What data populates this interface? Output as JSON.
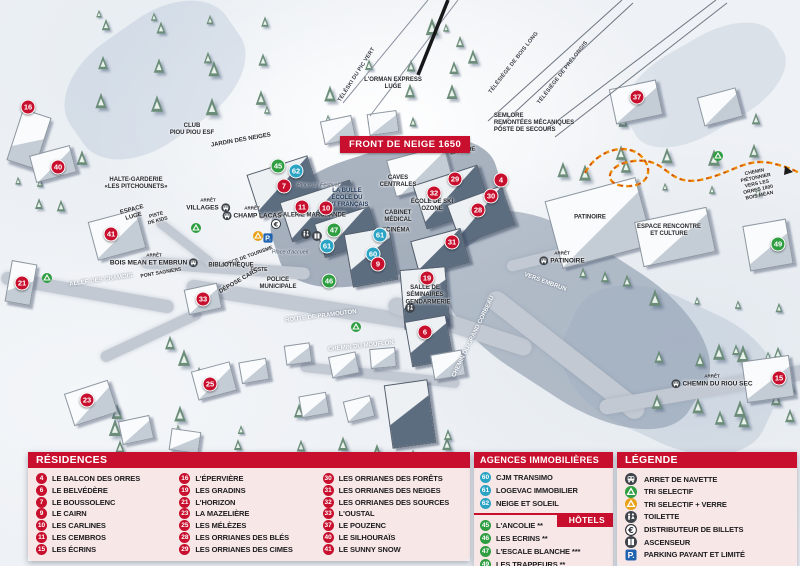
{
  "title_banner": "FRONT DE NEIGE 1650",
  "colors": {
    "accent_red": "#c8102e",
    "agency_blue": "#2ba3c4",
    "hotel_green": "#2f9e41",
    "parking_blue": "#1f63b0",
    "path_orange": "#f08c00",
    "icon_dark": "#3f444b",
    "recycle_yellow": "#e8a21a"
  },
  "map": {
    "markers": [
      {
        "n": "16",
        "c": "red",
        "x": 28,
        "y": 107
      },
      {
        "n": "40",
        "c": "red",
        "x": 58,
        "y": 167
      },
      {
        "n": "21",
        "c": "red",
        "x": 22,
        "y": 283
      },
      {
        "n": "41",
        "c": "red",
        "x": 111,
        "y": 234
      },
      {
        "n": "33",
        "c": "red",
        "x": 203,
        "y": 299
      },
      {
        "n": "23",
        "c": "red",
        "x": 87,
        "y": 400
      },
      {
        "n": "25",
        "c": "red",
        "x": 210,
        "y": 384
      },
      {
        "n": "45",
        "c": "green",
        "x": 278,
        "y": 166
      },
      {
        "n": "62",
        "c": "blue",
        "x": 296,
        "y": 171
      },
      {
        "n": "7",
        "c": "red",
        "x": 284,
        "y": 186
      },
      {
        "n": "11",
        "c": "red",
        "x": 302,
        "y": 207
      },
      {
        "n": "10",
        "c": "red",
        "x": 326,
        "y": 208
      },
      {
        "n": "47",
        "c": "green",
        "x": 334,
        "y": 230
      },
      {
        "n": "61",
        "c": "blue",
        "x": 327,
        "y": 246
      },
      {
        "n": "61",
        "c": "blue",
        "x": 380,
        "y": 235
      },
      {
        "n": "60",
        "c": "blue",
        "x": 373,
        "y": 254
      },
      {
        "n": "9",
        "c": "red",
        "x": 378,
        "y": 264
      },
      {
        "n": "46",
        "c": "green",
        "x": 329,
        "y": 281
      },
      {
        "n": "29",
        "c": "red",
        "x": 455,
        "y": 179
      },
      {
        "n": "32",
        "c": "red",
        "x": 434,
        "y": 193
      },
      {
        "n": "4",
        "c": "red",
        "x": 501,
        "y": 180
      },
      {
        "n": "30",
        "c": "red",
        "x": 491,
        "y": 196
      },
      {
        "n": "28",
        "c": "red",
        "x": 478,
        "y": 210
      },
      {
        "n": "31",
        "c": "red",
        "x": 452,
        "y": 242
      },
      {
        "n": "19",
        "c": "red",
        "x": 427,
        "y": 278
      },
      {
        "n": "6",
        "c": "red",
        "x": 425,
        "y": 332
      },
      {
        "n": "37",
        "c": "red",
        "x": 637,
        "y": 97
      },
      {
        "n": "49",
        "c": "green",
        "x": 778,
        "y": 244
      },
      {
        "n": "15",
        "c": "red",
        "x": 779,
        "y": 378
      }
    ],
    "labels": [
      {
        "t": "CLUB\nPIOU PIOU ESF",
        "x": 192,
        "y": 130
      },
      {
        "t": "JARDIN DES NEIGES",
        "x": 241,
        "y": 141,
        "rot": -10
      },
      {
        "t": "HALTE-GARDERIE\n«LES PITCHOUNETS»",
        "x": 136,
        "y": 184
      },
      {
        "t": "ESPACE\nLUGE",
        "x": 133,
        "y": 214,
        "rot": -15
      },
      {
        "t": "PISTE\nDE KIDS",
        "x": 157,
        "y": 218,
        "rot": -15,
        "cls": "tiny"
      },
      {
        "t": "TÉLÉSKI DU PIC VERT",
        "x": 357,
        "y": 75,
        "rot": -57,
        "cls": "lift"
      },
      {
        "t": "L'ORMAN EXPRESS\nLUGE",
        "x": 393,
        "y": 84
      },
      {
        "t": "TÉLÉSIÈGE DE BOIS LONG",
        "x": 514,
        "y": 63,
        "rot": -52,
        "cls": "lift"
      },
      {
        "t": "TÉLÉSIÈGE DE PRÉLONGIS",
        "x": 563,
        "y": 73,
        "rot": -52,
        "cls": "lift"
      },
      {
        "t": "SEMLORE\nREMONTÉES MÉCANIQUES\nPOSTE DE SECOURS",
        "x": 534,
        "y": 124,
        "cls": "left"
      },
      {
        "t": "LAVERIE",
        "x": 463,
        "y": 152,
        "rot": -10
      },
      {
        "t": "CAVES\nCENTRALES",
        "x": 398,
        "y": 182
      },
      {
        "t": "LA BULLE\nÉCOLE DU\nSKI FRANÇAIS",
        "x": 347,
        "y": 199,
        "cls": "navy"
      },
      {
        "t": "Place du Festival",
        "x": 318,
        "y": 186,
        "cls": "italic"
      },
      {
        "t": "GALERIE MARCHANDE",
        "x": 312,
        "y": 216
      },
      {
        "t": "ÉCOLE DE SKI\nOZONE",
        "x": 432,
        "y": 206
      },
      {
        "t": "CABINET\nMÉDICAL",
        "x": 398,
        "y": 217
      },
      {
        "t": "CINÉMA",
        "x": 398,
        "y": 231
      },
      {
        "t": "Place d'accueil",
        "x": 290,
        "y": 253,
        "cls": "italic"
      },
      {
        "t": "OFFICE DE TOURISME",
        "x": 247,
        "y": 257,
        "rot": -20,
        "cls": "tiny"
      },
      {
        "t": "POSTE",
        "x": 259,
        "y": 270,
        "cls": "tiny"
      },
      {
        "t": "BIBLIOTHÈQUE",
        "x": 231,
        "y": 266
      },
      {
        "t": "DÉPOSE CARS",
        "x": 239,
        "y": 282,
        "rot": -30
      },
      {
        "t": "POLICE\nMUNICIPALE",
        "x": 278,
        "y": 284
      },
      {
        "t": "PONT SAGNIERS",
        "x": 161,
        "y": 273,
        "rot": -10,
        "cls": "tiny"
      },
      {
        "t": "ALLÉE DES CHAMOIS",
        "x": 101,
        "y": 281,
        "rot": -8,
        "cls": "white"
      },
      {
        "t": "ROUTE DE PRAMOUTON",
        "x": 321,
        "y": 317,
        "rot": -7,
        "cls": "white"
      },
      {
        "t": "CHEMIN DU MOUFLON",
        "x": 361,
        "y": 347,
        "rot": -6,
        "cls": "white"
      },
      {
        "t": "CHEMIN DU GRAND CORBEAU",
        "x": 474,
        "y": 337,
        "rot": -64,
        "cls": "white"
      },
      {
        "t": "VERS EMBRUN",
        "x": 545,
        "y": 283,
        "rot": 20,
        "cls": "white"
      },
      {
        "t": "SALLE DE\nSÉMINAIRES",
        "x": 425,
        "y": 292
      },
      {
        "t": "GENDARMERIE",
        "x": 428,
        "y": 303
      },
      {
        "t": "PATINOIRE",
        "x": 590,
        "y": 218
      },
      {
        "t": "ESPACE RENCONTRE\nET CULTURE",
        "x": 669,
        "y": 231
      },
      {
        "t": "CHEMIN PIÉTONNIER\nVERS LES ORRES 1800\nBOIS MÉAN",
        "x": 757,
        "y": 184,
        "rot": -12,
        "cls": "tiny"
      }
    ],
    "bus_stops": {
      "caption": "ARRÊT",
      "stops": [
        {
          "name": "VILLAGES",
          "x": 208,
          "y": 205,
          "side": "right"
        },
        {
          "name": "CHAMP LACAS",
          "x": 252,
          "y": 213,
          "side": "left"
        },
        {
          "name": "BOIS MEAN ET EMBRUN",
          "x": 154,
          "y": 260,
          "side": "right"
        },
        {
          "name": "PATINOIRE",
          "x": 562,
          "y": 258,
          "side": "left"
        },
        {
          "name": "CHEMIN DU RIOU SEC",
          "x": 712,
          "y": 381,
          "side": "left"
        }
      ]
    },
    "icons": [
      {
        "i": "euro",
        "x": 276,
        "y": 224
      },
      {
        "i": "recycle_yellow",
        "x": 258,
        "y": 236
      },
      {
        "i": "parking",
        "x": 268,
        "y": 238
      },
      {
        "i": "wc",
        "x": 306,
        "y": 234
      },
      {
        "i": "lift",
        "x": 317,
        "y": 236
      },
      {
        "i": "recycle_green",
        "x": 47,
        "y": 278
      },
      {
        "i": "recycle_green",
        "x": 196,
        "y": 228
      },
      {
        "i": "recycle_green",
        "x": 356,
        "y": 327
      },
      {
        "i": "recycle_green",
        "x": 718,
        "y": 156
      },
      {
        "i": "wc",
        "x": 410,
        "y": 308
      }
    ]
  },
  "panels": {
    "residences": {
      "title": "RÉSIDENCES",
      "columns": [
        [
          {
            "n": "4",
            "label": "LE BALCON DES ORRES"
          },
          {
            "n": "6",
            "label": "LE BELVÉDÈRE"
          },
          {
            "n": "7",
            "label": "LE BOUSSOLENC"
          },
          {
            "n": "9",
            "label": "LE CAIRN"
          },
          {
            "n": "10",
            "label": "LES CARLINES"
          },
          {
            "n": "11",
            "label": "LES CEMBROS"
          },
          {
            "n": "15",
            "label": "LES ÉCRINS"
          }
        ],
        [
          {
            "n": "16",
            "label": "L'ÉPERVIÈRE"
          },
          {
            "n": "19",
            "label": "LES GRADINS"
          },
          {
            "n": "21",
            "label": "L'HORIZON"
          },
          {
            "n": "23",
            "label": "LA MAZELIÈRE"
          },
          {
            "n": "25",
            "label": "LES MÉLÈZES"
          },
          {
            "n": "28",
            "label": "LES ORRIANES DES BLÉS"
          },
          {
            "n": "29",
            "label": "LES ORRIANES DES CIMES"
          }
        ],
        [
          {
            "n": "30",
            "label": "LES ORRIANES DES FORÊTS"
          },
          {
            "n": "31",
            "label": "LES ORRIANES DES NEIGES"
          },
          {
            "n": "32",
            "label": "LES ORRIANES DES SOURCES"
          },
          {
            "n": "33",
            "label": "L'OUSTAL"
          },
          {
            "n": "37",
            "label": "LE POUZENC"
          },
          {
            "n": "40",
            "label": "LE SILHOURAÏS"
          },
          {
            "n": "41",
            "label": "LE SUNNY SNOW"
          }
        ]
      ]
    },
    "agences": {
      "title": "AGENCES IMMOBILIÈRES",
      "items": [
        {
          "n": "60",
          "label": "CJM TRANSIMO"
        },
        {
          "n": "61",
          "label": "LOGEVAC IMMOBILIER"
        },
        {
          "n": "62",
          "label": "NEIGE ET SOLEIL"
        }
      ]
    },
    "hotels": {
      "title": "HÔTELS",
      "items": [
        {
          "n": "45",
          "label": "L'ANCOLIE **"
        },
        {
          "n": "46",
          "label": "LES ECRINS **"
        },
        {
          "n": "47",
          "label": "L'ESCALE BLANCHE ***"
        },
        {
          "n": "49",
          "label": "LES TRAPPEURS **"
        }
      ]
    },
    "legende": {
      "title": "LÉGENDE",
      "items": [
        {
          "icon": "bus",
          "label": "ARRET DE NAVETTE"
        },
        {
          "icon": "recycle_green",
          "label": "TRI SELECTIF"
        },
        {
          "icon": "recycle_yellow",
          "label": "TRI SELECTIF + VERRE"
        },
        {
          "icon": "wc",
          "label": "TOILETTE"
        },
        {
          "icon": "euro",
          "label": "DISTRIBUTEUR DE BILLETS"
        },
        {
          "icon": "lift",
          "label": "ASCENSEUR"
        },
        {
          "icon": "parking",
          "label": "PARKING PAYANT ET LIMITÉ"
        }
      ]
    }
  }
}
